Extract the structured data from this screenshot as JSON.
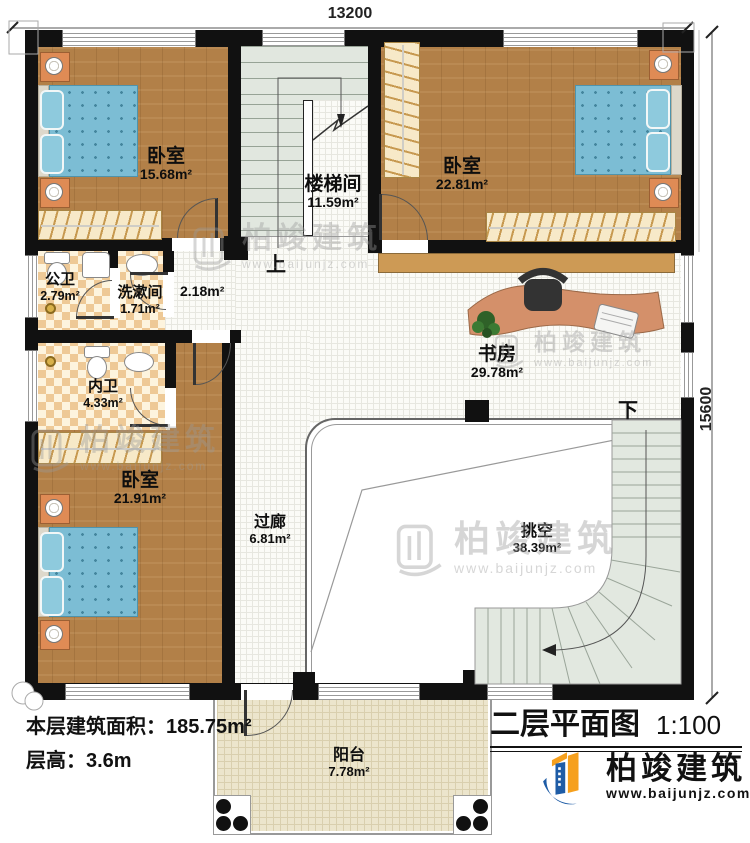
{
  "title_block": {
    "title": "二层平面图",
    "scale": "1:100"
  },
  "info": {
    "area_label": "本层建筑面积：",
    "area_value": "185.75m²",
    "height_label": "层高：",
    "height_value": "3.6m"
  },
  "dimensions": {
    "width": "13200",
    "height": "15600"
  },
  "rooms": {
    "bedroom_tl": {
      "name": "卧室",
      "area": "15.68m²"
    },
    "stairwell": {
      "name": "楼梯间",
      "area": "11.59m²"
    },
    "bedroom_tr": {
      "name": "卧室",
      "area": "22.81m²"
    },
    "public_bath": {
      "name": "公卫",
      "area": "2.79m²"
    },
    "washroom": {
      "name": "洗漱间",
      "area": "1.71m²"
    },
    "hall_small": {
      "area": "2.18m²"
    },
    "study": {
      "name": "书房",
      "area": "29.78m²"
    },
    "private_bath": {
      "name": "内卫",
      "area": "4.33m²"
    },
    "bedroom_bl": {
      "name": "卧室",
      "area": "21.91m²"
    },
    "corridor": {
      "name": "过廊",
      "area": "6.81m²"
    },
    "void": {
      "name": "挑空",
      "area": "38.39m²"
    },
    "balcony": {
      "name": "阳台",
      "area": "7.78m²"
    }
  },
  "stairs": {
    "up": "上",
    "down": "下"
  },
  "watermark": {
    "name": "柏竣建筑",
    "website": "www.baijunjz.com"
  },
  "brand": {
    "name": "柏竣建筑",
    "website": "www.baijunjz.com"
  },
  "colors": {
    "wall": "#111111",
    "wood_floor": "#b28048",
    "tile_checker": "#eec996",
    "stair_fill": "#e1e7df",
    "bed_blue": "#7cbdd4",
    "balcony_floor": "#ece5cc",
    "logo_blue": "#1e5ca6",
    "logo_orange": "#f6a01d",
    "watermark_gray": "#9a9a9a"
  }
}
